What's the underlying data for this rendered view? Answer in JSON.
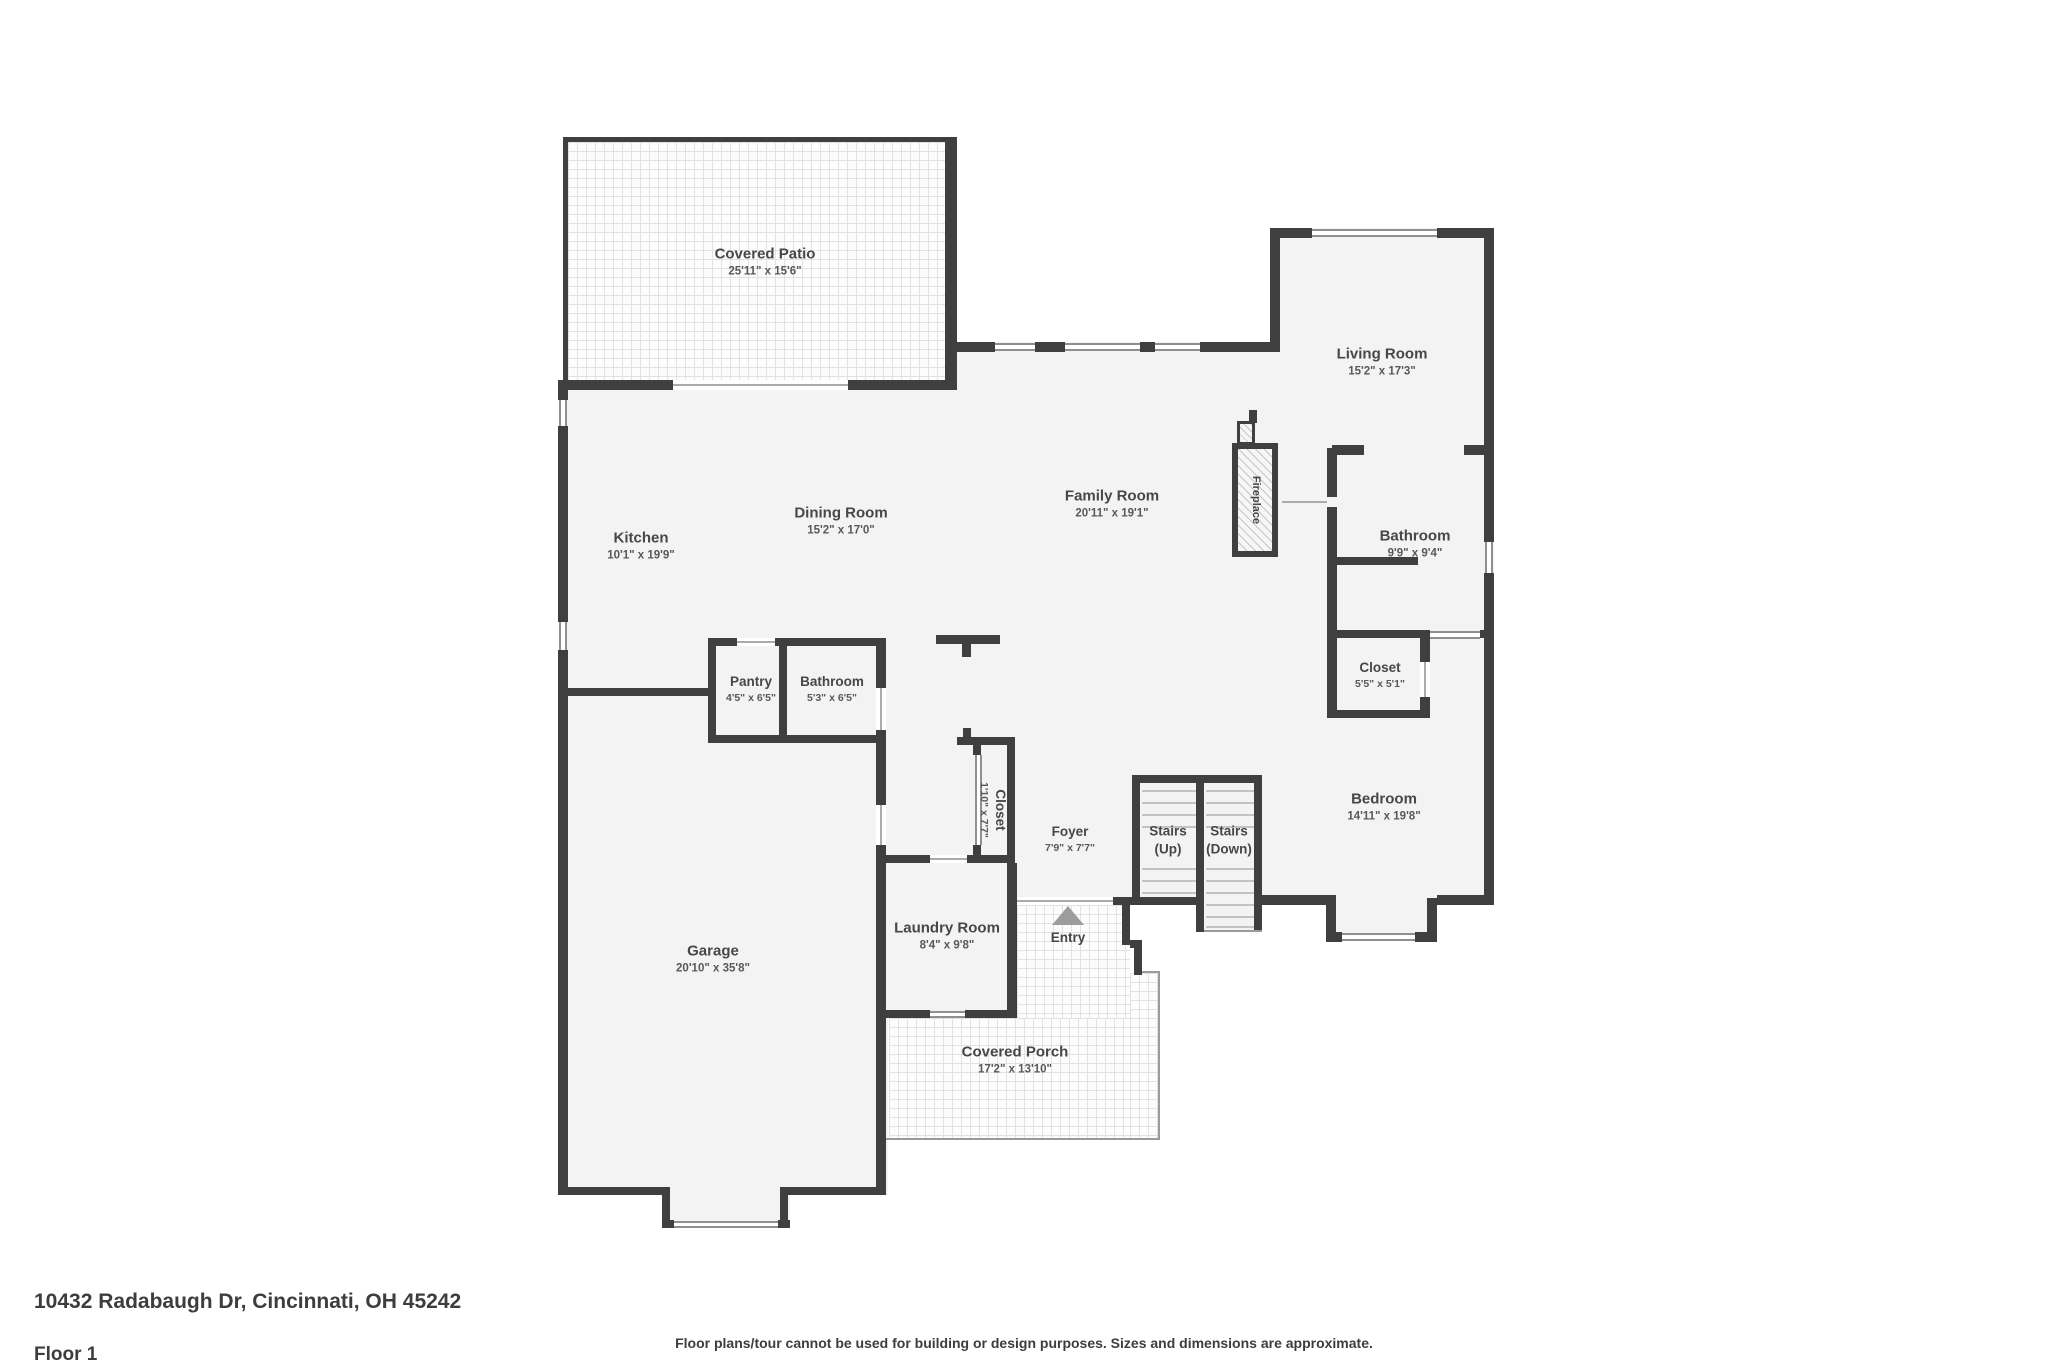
{
  "colors": {
    "wall": "#3f3f3f",
    "floor": "#f3f3f3",
    "label_text": "#474747",
    "entry_arrow": "#9c9c9c"
  },
  "rooms": [
    {
      "id": "covered-patio",
      "name": "Covered Patio",
      "dims": "25'11\" x 15'6\""
    },
    {
      "id": "living-room",
      "name": "Living Room",
      "dims": "15'2\" x 17'3\""
    },
    {
      "id": "kitchen",
      "name": "Kitchen",
      "dims": "10'1\" x 19'9\""
    },
    {
      "id": "dining-room",
      "name": "Dining Room",
      "dims": "15'2\" x 17'0\""
    },
    {
      "id": "family-room",
      "name": "Family Room",
      "dims": "20'11\" x 19'1\""
    },
    {
      "id": "bathroom-main",
      "name": "Bathroom",
      "dims": "9'9\" x 9'4\""
    },
    {
      "id": "pantry",
      "name": "Pantry",
      "dims": "4'5\" x 6'5\""
    },
    {
      "id": "bathroom-small",
      "name": "Bathroom",
      "dims": "5'3\" x 6'5\""
    },
    {
      "id": "closet-bedroom",
      "name": "Closet",
      "dims": "5'5\" x 5'1\""
    },
    {
      "id": "closet-foyer",
      "name": "Closet",
      "dims": "1'10\" x 7'7\""
    },
    {
      "id": "foyer",
      "name": "Foyer",
      "dims": "7'9\" x 7'7\""
    },
    {
      "id": "bedroom",
      "name": "Bedroom",
      "dims": "14'11\" x 19'8\""
    },
    {
      "id": "garage",
      "name": "Garage",
      "dims": "20'10\" x 35'8\""
    },
    {
      "id": "laundry-room",
      "name": "Laundry Room",
      "dims": "8'4\" x 9'8\""
    },
    {
      "id": "covered-porch",
      "name": "Covered Porch",
      "dims": "17'2\" x 13'10\""
    }
  ],
  "labels": {
    "entry": "Entry",
    "fireplace": "Fireplace",
    "stairs_up_line1": "Stairs",
    "stairs_up_line2": "(Up)",
    "stairs_down_line1": "Stairs",
    "stairs_down_line2": "(Down)"
  },
  "footer": {
    "address": "10432 Radabaugh Dr, Cincinnati, OH 45242",
    "floor": "Floor 1",
    "disclaimer": "Floor plans/tour cannot be used for building or design purposes. Sizes and dimensions are approximate."
  }
}
